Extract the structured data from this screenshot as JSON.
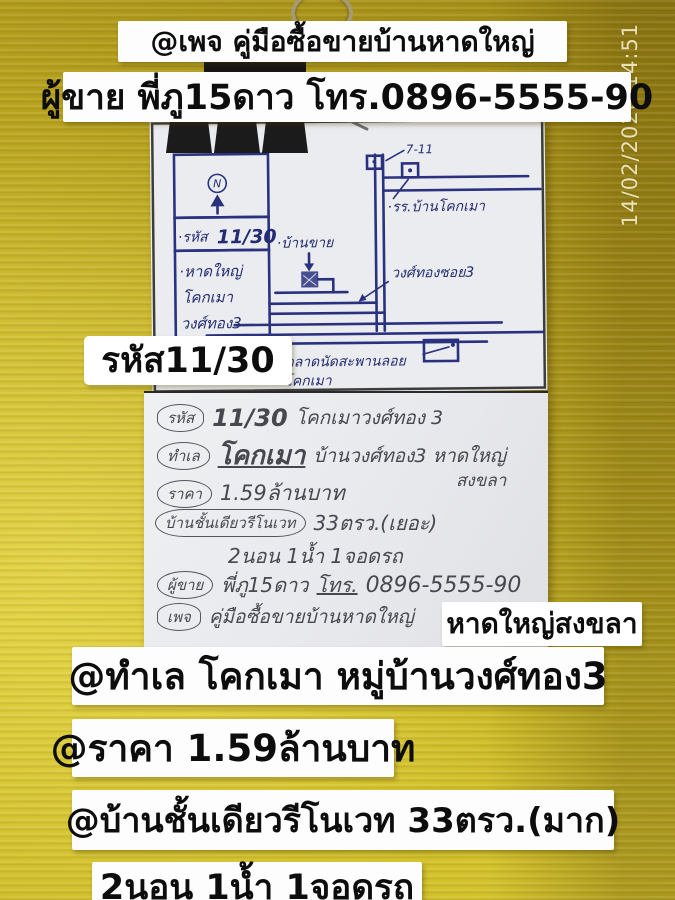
{
  "overlay": {
    "timestamp": "14/02/2026 14:51",
    "top_line1": "@เพจ คู่มือซื้อขายบ้านหาดใหญ่",
    "top_line2": "ผู้ขาย พี่ภู15ดาว โทร.0896-5555-90",
    "code_label": "รหัส11/30",
    "area_label": "หาดใหญ่สงขลา",
    "bottom_line1": "@ทำเล โคกเมา หมู่บ้านวงศ์ทอง3",
    "bottom_line2": "@ราคา 1.59ล้านบาท",
    "bottom_line3": "@บ้านชั้นเดียวรีโนเวท 33ตรว.(มาก)",
    "bottom_line4": "2นอน 1น้ำ 1จอดรถ"
  },
  "map": {
    "compass": "N",
    "code_prefix": "·รหัส",
    "code_value": "11/30",
    "area_line1": "·หาดใหญ่",
    "area_line2": "โคกเมา",
    "area_line3": "วงศ์ทอง3",
    "poi_711": "7-11",
    "poi_school": "·รร.บ้านโคกเมา",
    "poi_house": "·บ้านขาย",
    "poi_soi": "วงศ์ทองซอย3",
    "poi_market_line1": "·ตลาดนัดสะพานลอย",
    "poi_market_line2": "โคกเมา"
  },
  "note": {
    "code_label": "รหัส",
    "code_value": "11/30",
    "code_rest": "โคกเมาวงศ์ทอง 3",
    "loc_label": "ทำเล",
    "loc_em": "โคกเมา",
    "loc_rest": "บ้านวงศ์ทอง3 หาดใหญ่",
    "loc_rest2": "สงขลา",
    "price_label": "ราคา",
    "price_value": "1.59ล้านบาท",
    "house_label": "บ้านชั้นเดียวรีโนเวท",
    "house_value": "33ตรว.(เยอะ)",
    "rooms": "2นอน 1น้ำ 1จอดรถ",
    "seller_label": "ผู้ขาย",
    "seller_value": "พี่ภู15ดาว",
    "tel_label": "โทร.",
    "tel_value": "0896-5555-90",
    "page_label": "เพจ",
    "page_value": "คู่มือซื้อขายบ้านหาดใหญ่"
  },
  "colors": {
    "board_yellow": "#d5c32c",
    "board_olive": "#a18a16",
    "paper": "#ebecef",
    "ink_navy": "#2a3280",
    "pencil": "#474750",
    "strip_white": "#fdfdfd",
    "text_black": "#0d0d0d",
    "timestamp": "#e9e2b8"
  }
}
